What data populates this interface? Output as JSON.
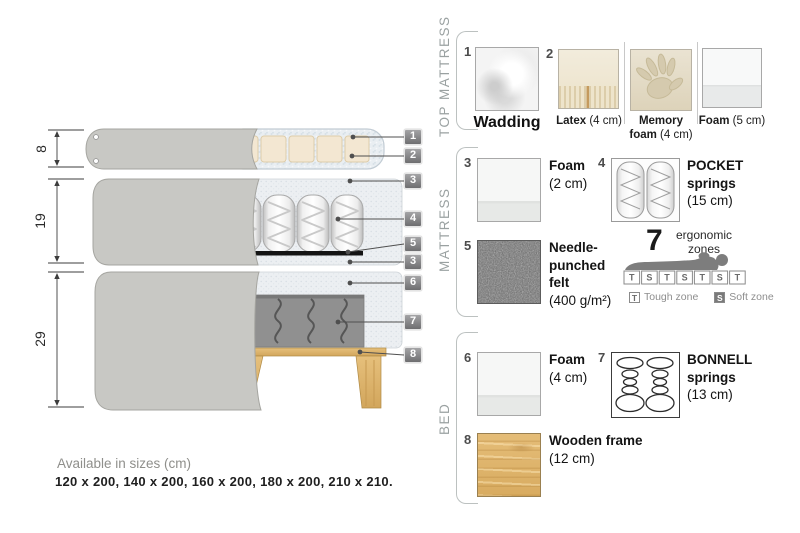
{
  "sections": {
    "top_mattress": {
      "label": "TOP MATTRESS",
      "wadding": {
        "num": "1",
        "name": "Wadding"
      },
      "latex": {
        "num": "2",
        "name": "Latex",
        "size": "(4 cm)"
      },
      "memory": {
        "name1": "Memory",
        "name2": "foam",
        "size": "(4 cm)"
      },
      "foam": {
        "name": "Foam",
        "size": "(5 cm)"
      }
    },
    "mattress": {
      "label": "MATTRESS",
      "foam": {
        "num": "3",
        "name": "Foam",
        "size": "(2 cm)"
      },
      "pocket": {
        "num": "4",
        "name1": "POCKET",
        "name2": "springs",
        "size": "(15 cm)"
      },
      "felt": {
        "num": "5",
        "name1": "Needle-",
        "name2": "punched",
        "name3": "felt",
        "size": "(400 g/m²)"
      },
      "ergonomic": {
        "big": "7",
        "label1": "ergonomic",
        "label2": "zones",
        "zones": [
          "T",
          "S",
          "T",
          "S",
          "T",
          "S",
          "T"
        ],
        "tough_key": "T",
        "tough": "Tough zone",
        "soft_key": "S",
        "soft": "Soft zone"
      }
    },
    "bed": {
      "label": "BED",
      "foam": {
        "num": "6",
        "name": "Foam",
        "size": "(4 cm)"
      },
      "bonnell": {
        "num": "7",
        "name1": "BONNELL",
        "name2": "springs",
        "size": "(13 cm)"
      },
      "frame": {
        "num": "8",
        "name": "Wooden frame",
        "size": "(12 cm)"
      }
    }
  },
  "diagram": {
    "dims": {
      "top": "8",
      "middle": "19",
      "bottom": "29"
    },
    "callouts": [
      "1",
      "2",
      "3",
      "4",
      "5",
      "3",
      "6",
      "7",
      "8"
    ]
  },
  "footer": {
    "title": "Available in sizes (cm)",
    "sizes": "120 x 200, 140 x 200, 160 x 200, 180 x 200, 210 x 210."
  },
  "colors": {
    "fabric_gray": "#c8c8c4",
    "wadding": "#e9eef2",
    "latex": "#f3e7d2",
    "foam_speckle": "#eceff2",
    "felt": "#141414",
    "bonnell_area": "#909090",
    "wood": "#ddb26e",
    "muted_text": "#9aa1a1"
  }
}
